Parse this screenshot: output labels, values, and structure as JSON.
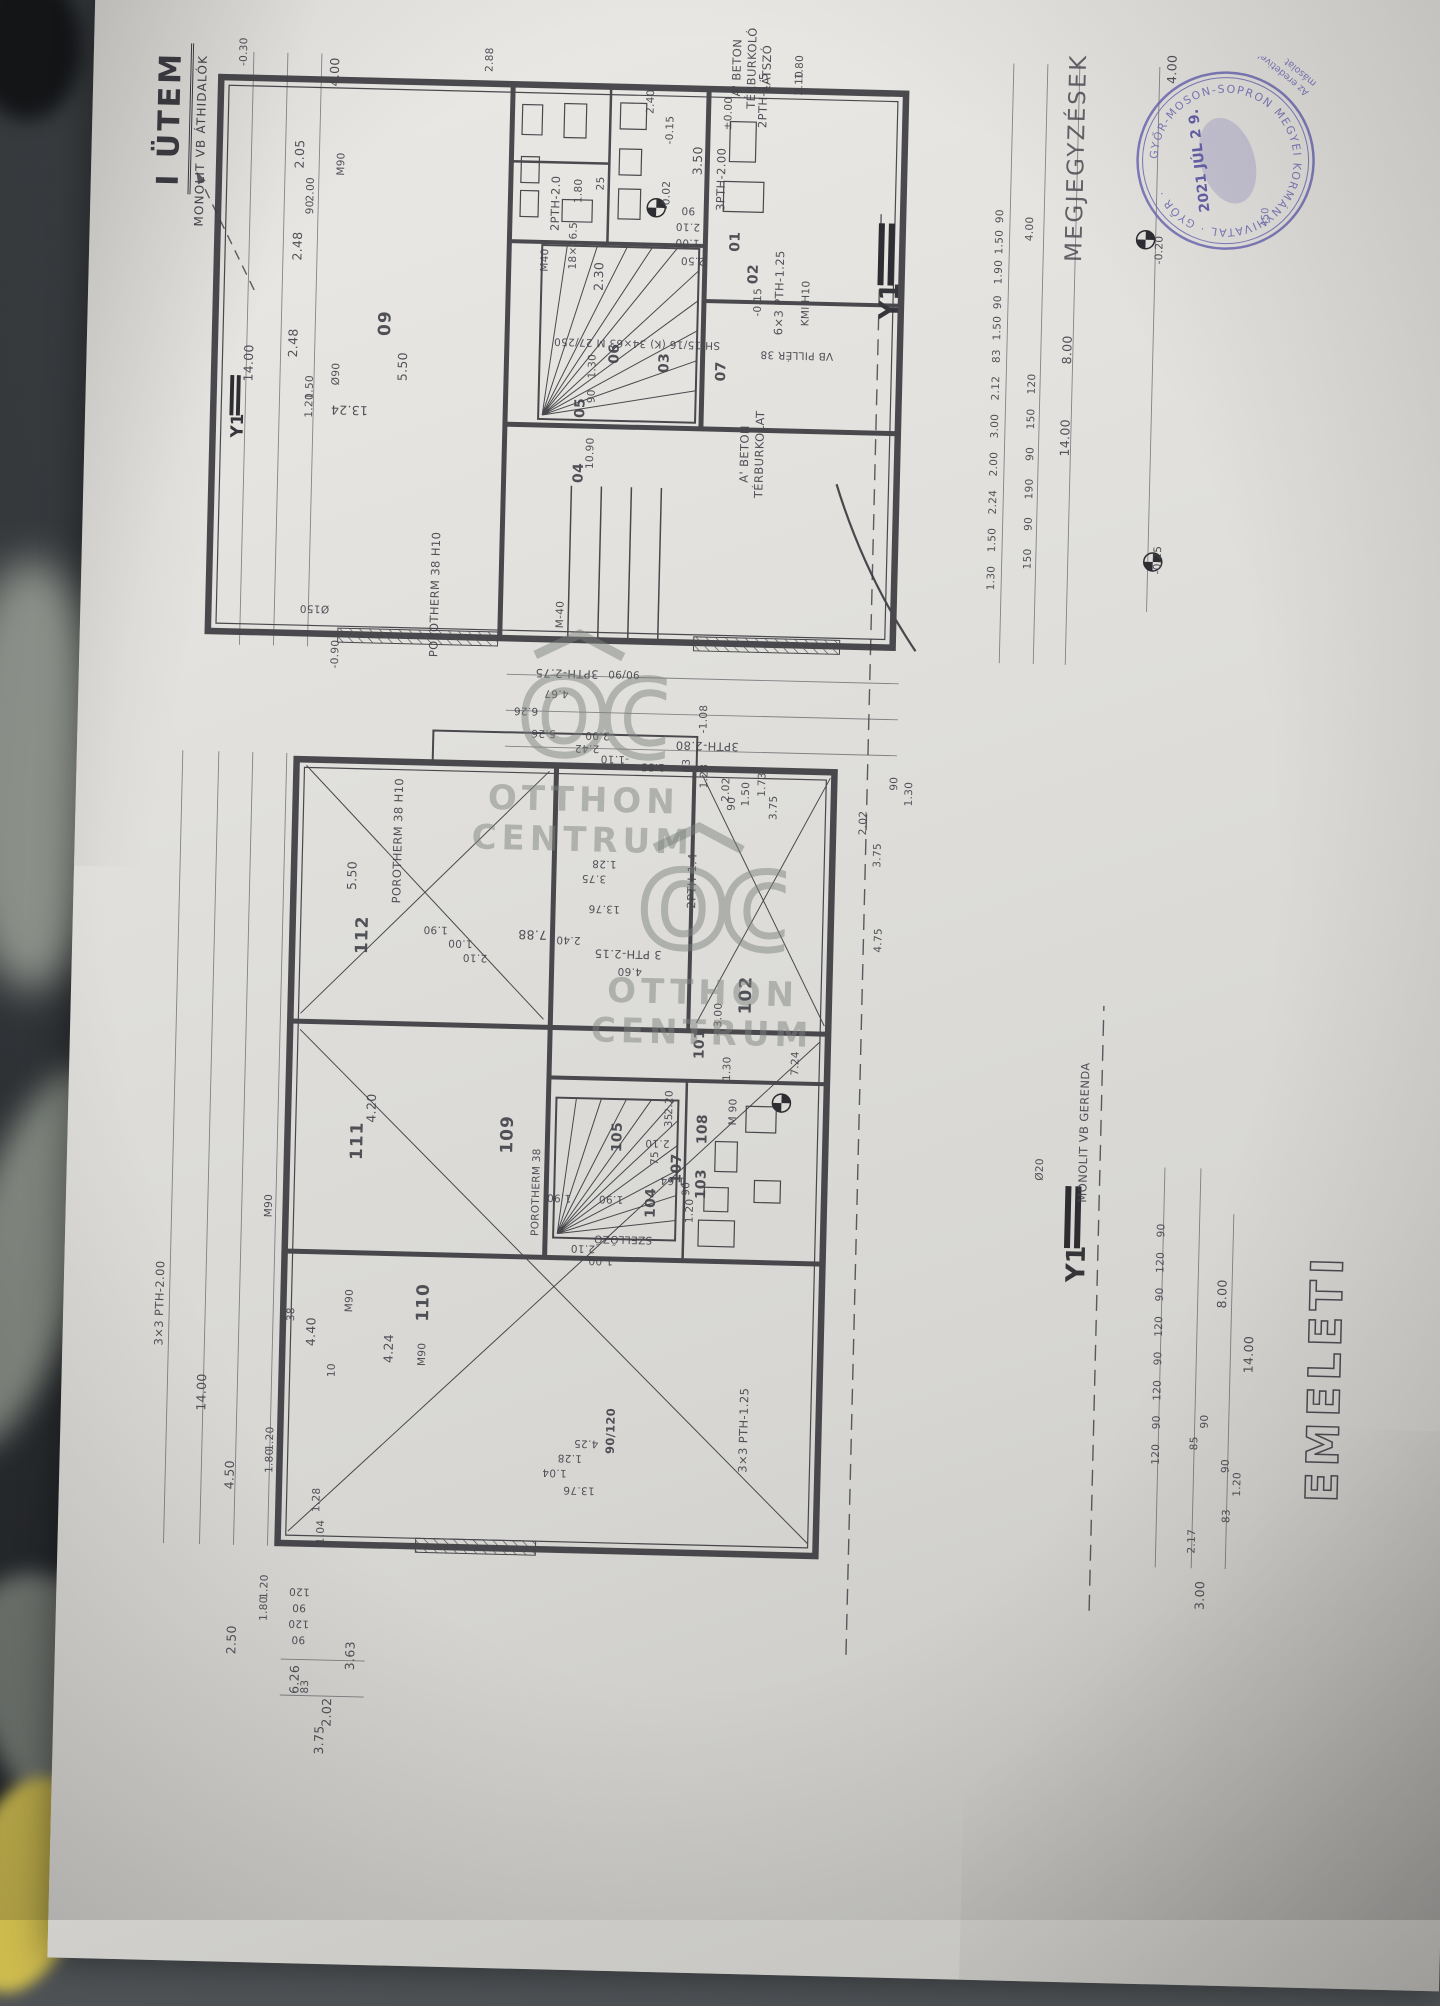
{
  "titles": {
    "phase": "I ÜTEM",
    "phase_note": "MONOLIT VB ÁTHIDALÓK",
    "sheet": "EMELETI",
    "notes_heading": "MEGJEGYZÉSEK:"
  },
  "axis": {
    "y1": "Y1"
  },
  "stamp": {
    "ring_text": "GYŐR-MOSON-SOPRON MEGYEI KORMÁNYHIVATAL · GYŐR ·",
    "date": "2021 JÚL 2 9.",
    "number": "450",
    "note_line1": "Az eredetivel megegyező",
    "note_line2": "másolat"
  },
  "watermark": {
    "logo": "OC",
    "line1": "OTTHON",
    "line2": "CENTRUM"
  },
  "labels": [
    {
      "t": "-0.30",
      "x": 1838,
      "y": 92,
      "c": "sm"
    },
    {
      "t": "4.00",
      "x": 1820,
      "y": 183
    },
    {
      "t": "2.05",
      "x": 1737,
      "y": 150
    },
    {
      "t": "2.00",
      "x": 1702,
      "y": 162,
      "c": "sm"
    },
    {
      "t": "90",
      "x": 1684,
      "y": 162,
      "c": "sm"
    },
    {
      "t": "2.48",
      "x": 1645,
      "y": 150
    },
    {
      "t": "2.48",
      "x": 1548,
      "y": 148
    },
    {
      "t": "14.00",
      "x": 1527,
      "y": 104
    },
    {
      "t": "1.50",
      "x": 1504,
      "y": 166,
      "c": "sm"
    },
    {
      "t": "1.20",
      "x": 1486,
      "y": 166,
      "c": "sm"
    },
    {
      "t": "Ø90",
      "x": 1518,
      "y": 192,
      "c": "sm"
    },
    {
      "t": "M90",
      "x": 1728,
      "y": 192,
      "c": "sm"
    },
    {
      "t": "2.88",
      "x": 1836,
      "y": 338,
      "c": "sm"
    },
    {
      "t": "09",
      "x": 1570,
      "y": 240,
      "c": "room"
    },
    {
      "t": "5.50",
      "x": 1527,
      "y": 258
    },
    {
      "t": "13.24",
      "x": 1482,
      "y": 206,
      "r": -90
    },
    {
      "t": "Ø150",
      "x": 1283,
      "y": 176,
      "r": -90,
      "c": "sm"
    },
    {
      "t": "-0.90",
      "x": 1238,
      "y": 198,
      "c": "sm"
    },
    {
      "t": "POROTHERM 38 H10",
      "x": 1300,
      "y": 296,
      "c": "note"
    },
    {
      "t": "2PTH-2.0",
      "x": 1694,
      "y": 407,
      "c": "note"
    },
    {
      "t": "1.80",
      "x": 1707,
      "y": 430,
      "c": "sm"
    },
    {
      "t": "25",
      "x": 1715,
      "y": 452,
      "c": "sm"
    },
    {
      "t": "2.30",
      "x": 1622,
      "y": 452
    },
    {
      "t": "1.30",
      "x": 1532,
      "y": 448,
      "c": "sm"
    },
    {
      "t": "90",
      "x": 1502,
      "y": 448,
      "c": "sm"
    },
    {
      "t": "10.90",
      "x": 1445,
      "y": 448,
      "c": "sm"
    },
    {
      "t": "SH 15/16 (K) 34×63 M 27/250",
      "x": 1556,
      "y": 492,
      "r": -90,
      "c": "sm"
    },
    {
      "t": "18×16.5",
      "x": 1652,
      "y": 426,
      "c": "sm"
    },
    {
      "t": "M40",
      "x": 1637,
      "y": 398,
      "c": "sm"
    },
    {
      "t": "05",
      "x": 1490,
      "y": 437,
      "c": "room-sm"
    },
    {
      "t": "04",
      "x": 1425,
      "y": 437,
      "c": "room-sm"
    },
    {
      "t": "06",
      "x": 1545,
      "y": 470,
      "c": "room-sm"
    },
    {
      "t": "07",
      "x": 1530,
      "y": 577,
      "c": "room-sm"
    },
    {
      "t": "03",
      "x": 1537,
      "y": 520,
      "c": "room-sm"
    },
    {
      "t": "1.00",
      "x": 1658,
      "y": 540,
      "r": -90,
      "c": "sm"
    },
    {
      "t": "2.10",
      "x": 1674,
      "y": 540,
      "r": -90,
      "c": "sm"
    },
    {
      "t": "90",
      "x": 1690,
      "y": 540,
      "r": -90,
      "c": "sm"
    },
    {
      "t": "2.50",
      "x": 1640,
      "y": 546,
      "r": -90,
      "c": "sm"
    },
    {
      "t": "01",
      "x": 1660,
      "y": 588,
      "c": "room-sm"
    },
    {
      "t": "3PTH-2.00",
      "x": 1722,
      "y": 572,
      "c": "note"
    },
    {
      "t": "3.50",
      "x": 1740,
      "y": 548
    },
    {
      "t": "±0.00",
      "x": 1788,
      "y": 578,
      "c": "sm"
    },
    {
      "t": "2PTH-1.5",
      "x": 1802,
      "y": 612,
      "c": "note"
    },
    {
      "t": "2.10",
      "x": 1820,
      "y": 648,
      "c": "sm"
    },
    {
      "t": "1.80",
      "x": 1836,
      "y": 648,
      "c": "sm"
    },
    {
      "t": "02",
      "x": 1628,
      "y": 607,
      "c": "room-sm"
    },
    {
      "t": "6×3 PTH-1.25",
      "x": 1610,
      "y": 633,
      "c": "note"
    },
    {
      "t": "KMI H10",
      "x": 1600,
      "y": 660,
      "c": "sm"
    },
    {
      "t": "VB PILLÉR 38",
      "x": 1548,
      "y": 652,
      "r": -90,
      "c": "sm"
    },
    {
      "t": "A' BETON",
      "x": 1834,
      "y": 585,
      "c": "note"
    },
    {
      "t": "TÉRBURKOLÓ",
      "x": 1834,
      "y": 600,
      "c": "note"
    },
    {
      "t": "LÁTSZÓ",
      "x": 1834,
      "y": 615,
      "c": "note"
    },
    {
      "t": "A' BETON",
      "x": 1448,
      "y": 602,
      "c": "note"
    },
    {
      "t": "TÉRBURKOLAT",
      "x": 1448,
      "y": 617,
      "c": "note"
    },
    {
      "t": "-0.15",
      "x": 1770,
      "y": 520,
      "c": "sm"
    },
    {
      "t": "-0.02",
      "x": 1705,
      "y": 518,
      "c": "sm"
    },
    {
      "t": "2.40",
      "x": 1798,
      "y": 500,
      "c": "sm"
    },
    {
      "t": "-0.15",
      "x": 1600,
      "y": 612,
      "c": "sm"
    },
    {
      "t": "6.26",
      "x": 1186,
      "y": 390,
      "r": -90,
      "c": "sm"
    },
    {
      "t": "4.67",
      "x": 1204,
      "y": 420,
      "r": -90,
      "c": "sm"
    },
    {
      "t": "5.26",
      "x": 1164,
      "y": 408,
      "r": -90,
      "c": "sm"
    },
    {
      "t": "3PTH-2.75",
      "x": 1224,
      "y": 430,
      "r": -90,
      "c": "note"
    },
    {
      "t": "3PTH-2.80",
      "x": 1155,
      "y": 572,
      "r": -90,
      "c": "note"
    },
    {
      "t": "M-40",
      "x": 1283,
      "y": 422,
      "c": "sm"
    },
    {
      "t": "2.42",
      "x": 1150,
      "y": 452,
      "r": -90,
      "c": "sm"
    },
    {
      "t": "2.00",
      "x": 1163,
      "y": 462,
      "r": -90,
      "c": "sm"
    },
    {
      "t": "-1.10",
      "x": 1140,
      "y": 480,
      "r": -90,
      "c": "sm"
    },
    {
      "t": "1.55",
      "x": 1133,
      "y": 518,
      "r": -90,
      "c": "sm"
    },
    {
      "t": "-1.08",
      "x": 1182,
      "y": 568,
      "c": "sm"
    },
    {
      "t": "90/90",
      "x": 1225,
      "y": 487,
      "r": -90,
      "c": "sm"
    },
    {
      "t": "1.50",
      "x": 1108,
      "y": 612,
      "c": "sm"
    },
    {
      "t": "90",
      "x": 1098,
      "y": 598,
      "c": "sm"
    },
    {
      "t": "1.73",
      "x": 1118,
      "y": 628,
      "c": "sm"
    },
    {
      "t": "2.02",
      "x": 1112,
      "y": 592,
      "c": "sm"
    },
    {
      "t": "1.28",
      "x": 1125,
      "y": 570,
      "c": "sm"
    },
    {
      "t": "83",
      "x": 1135,
      "y": 552,
      "c": "sm"
    },
    {
      "t": "3.75",
      "x": 1095,
      "y": 640,
      "c": "sm"
    },
    {
      "t": "2.02",
      "x": 1082,
      "y": 730,
      "c": "sm"
    },
    {
      "t": "3.75",
      "x": 1050,
      "y": 745,
      "c": "sm"
    },
    {
      "t": "90",
      "x": 1122,
      "y": 760,
      "c": "sm"
    },
    {
      "t": "1.30",
      "x": 1112,
      "y": 775,
      "c": "sm"
    },
    {
      "t": "4.75",
      "x": 965,
      "y": 748,
      "c": "sm"
    },
    {
      "t": "112",
      "x": 958,
      "y": 232,
      "c": "room"
    },
    {
      "t": "111",
      "x": 752,
      "y": 232,
      "c": "room"
    },
    {
      "t": "110",
      "x": 592,
      "y": 302,
      "c": "room"
    },
    {
      "t": "109",
      "x": 762,
      "y": 382,
      "c": "room"
    },
    {
      "t": "101",
      "x": 857,
      "y": 572,
      "c": "room-sm"
    },
    {
      "t": "+3.00",
      "x": 882,
      "y": 590,
      "c": "sm"
    },
    {
      "t": "102",
      "x": 907,
      "y": 617,
      "c": "room"
    },
    {
      "t": "7.24",
      "x": 840,
      "y": 668,
      "c": "sm"
    },
    {
      "t": "103",
      "x": 717,
      "y": 577,
      "c": "room-sm"
    },
    {
      "t": "104",
      "x": 697,
      "y": 527,
      "c": "room-sm"
    },
    {
      "t": "105",
      "x": 762,
      "y": 492,
      "c": "room-sm"
    },
    {
      "t": "107",
      "x": 732,
      "y": 552,
      "c": "room-sm"
    },
    {
      "t": "108",
      "x": 772,
      "y": 577,
      "c": "room-sm"
    },
    {
      "t": "4.20",
      "x": 785,
      "y": 245
    },
    {
      "t": "4.40",
      "x": 560,
      "y": 190
    },
    {
      "t": "38",
      "x": 577,
      "y": 170,
      "c": "sm"
    },
    {
      "t": "4.24",
      "x": 545,
      "y": 268
    },
    {
      "t": "M90",
      "x": 592,
      "y": 228,
      "c": "sm"
    },
    {
      "t": "M90",
      "x": 540,
      "y": 302,
      "c": "sm"
    },
    {
      "t": "M90",
      "x": 685,
      "y": 145,
      "c": "sm"
    },
    {
      "t": "10",
      "x": 522,
      "y": 212,
      "c": "sm"
    },
    {
      "t": "5.50",
      "x": 1017,
      "y": 220
    },
    {
      "t": "1.90",
      "x": 965,
      "y": 305,
      "r": -90,
      "c": "sm"
    },
    {
      "t": "1.00",
      "x": 952,
      "y": 330,
      "r": -90,
      "c": "sm"
    },
    {
      "t": "2.10",
      "x": 938,
      "y": 345,
      "r": -90,
      "c": "sm"
    },
    {
      "t": "POROTHERM 38 H10",
      "x": 1053,
      "y": 265,
      "c": "note"
    },
    {
      "t": "3 PTH-2.15",
      "x": 945,
      "y": 498,
      "r": -90,
      "c": "note"
    },
    {
      "t": "2.40",
      "x": 958,
      "y": 438,
      "r": -90,
      "c": "sm"
    },
    {
      "t": "4.60",
      "x": 928,
      "y": 500,
      "r": -90,
      "c": "sm"
    },
    {
      "t": "1.90",
      "x": 700,
      "y": 435,
      "r": -90,
      "c": "sm"
    },
    {
      "t": "1.90",
      "x": 700,
      "y": 487,
      "r": -90,
      "c": "sm"
    },
    {
      "t": "2.10",
      "x": 650,
      "y": 460,
      "r": -90,
      "c": "sm"
    },
    {
      "t": "1.00",
      "x": 638,
      "y": 478,
      "r": -90,
      "c": "sm"
    },
    {
      "t": "2.20",
      "x": 798,
      "y": 543,
      "c": "sm"
    },
    {
      "t": "35",
      "x": 780,
      "y": 543,
      "c": "sm"
    },
    {
      "t": "M 90",
      "x": 790,
      "y": 607,
      "c": "sm"
    },
    {
      "t": "1.30",
      "x": 833,
      "y": 600,
      "c": "sm"
    },
    {
      "t": "75",
      "x": 742,
      "y": 530,
      "c": "sm"
    },
    {
      "t": "2.10",
      "x": 757,
      "y": 532,
      "r": -90,
      "c": "sm"
    },
    {
      "t": "1.64",
      "x": 720,
      "y": 548,
      "r": -90,
      "c": "sm"
    },
    {
      "t": "90",
      "x": 712,
      "y": 562,
      "c": "sm"
    },
    {
      "t": "1.20",
      "x": 690,
      "y": 566,
      "c": "sm"
    },
    {
      "t": "SZELLŐZŐ",
      "x": 660,
      "y": 500,
      "r": -90,
      "c": "sm"
    },
    {
      "t": "POROTHERM 38",
      "x": 705,
      "y": 412,
      "c": "sm"
    },
    {
      "t": "90/120",
      "x": 468,
      "y": 492,
      "c": "smb"
    },
    {
      "t": "2PTH-1.4",
      "x": 1020,
      "y": 560,
      "c": "note"
    },
    {
      "t": "3×3 PTH-1.25",
      "x": 472,
      "y": 625,
      "c": "note"
    },
    {
      "t": "1.04",
      "x": 425,
      "y": 437,
      "r": -90,
      "c": "sm"
    },
    {
      "t": "1.28",
      "x": 440,
      "y": 452,
      "r": -90,
      "c": "sm"
    },
    {
      "t": "4.25",
      "x": 455,
      "y": 468,
      "r": -90,
      "c": "sm"
    },
    {
      "t": "13.76",
      "x": 408,
      "y": 462,
      "r": -90,
      "c": "sm"
    },
    {
      "t": "13.76",
      "x": 990,
      "y": 473,
      "r": -90,
      "c": "sm"
    },
    {
      "t": "3.75",
      "x": 1020,
      "y": 462,
      "r": -90,
      "c": "sm"
    },
    {
      "t": "1.28",
      "x": 1035,
      "y": 472,
      "r": -90,
      "c": "sm"
    },
    {
      "t": "7.88",
      "x": 962,
      "y": 402,
      "r": -90
    },
    {
      "t": "3×3 PTH-2.00",
      "x": 585,
      "y": 38,
      "c": "note"
    },
    {
      "t": "14.00",
      "x": 497,
      "y": 82
    },
    {
      "t": "4.50",
      "x": 415,
      "y": 112
    },
    {
      "t": "2.50",
      "x": 250,
      "y": 118
    },
    {
      "t": "1.80",
      "x": 430,
      "y": 152,
      "c": "sm"
    },
    {
      "t": "1.20",
      "x": 452,
      "y": 152,
      "c": "sm"
    },
    {
      "t": "1.80",
      "x": 282,
      "y": 150,
      "c": "sm"
    },
    {
      "t": "1.20",
      "x": 304,
      "y": 150,
      "c": "sm"
    },
    {
      "t": "120",
      "x": 458,
      "y": 1038,
      "c": "sm"
    },
    {
      "t": "90",
      "x": 490,
      "y": 1038,
      "c": "sm"
    },
    {
      "t": "120",
      "x": 522,
      "y": 1038,
      "c": "sm"
    },
    {
      "t": "90",
      "x": 554,
      "y": 1038,
      "c": "sm"
    },
    {
      "t": "120",
      "x": 586,
      "y": 1038,
      "c": "sm"
    },
    {
      "t": "90",
      "x": 618,
      "y": 1038,
      "c": "sm"
    },
    {
      "t": "120",
      "x": 650,
      "y": 1038,
      "c": "sm"
    },
    {
      "t": "90",
      "x": 682,
      "y": 1038,
      "c": "sm"
    },
    {
      "t": "85",
      "x": 470,
      "y": 1076,
      "c": "sm"
    },
    {
      "t": "90",
      "x": 492,
      "y": 1086,
      "c": "sm"
    },
    {
      "t": "8.00",
      "x": 620,
      "y": 1100
    },
    {
      "t": "14.00",
      "x": 560,
      "y": 1128
    },
    {
      "t": "2.17",
      "x": 372,
      "y": 1076,
      "c": "sm"
    },
    {
      "t": "3.00",
      "x": 318,
      "y": 1085
    },
    {
      "t": "1.20",
      "x": 430,
      "y": 1120,
      "c": "sm"
    },
    {
      "t": "83",
      "x": 398,
      "y": 1110,
      "c": "sm"
    },
    {
      "t": "90",
      "x": 448,
      "y": 1108,
      "c": "sm"
    },
    {
      "t": "3.63",
      "x": 237,
      "y": 237
    },
    {
      "t": "6.26",
      "x": 212,
      "y": 182
    },
    {
      "t": "2.02",
      "x": 180,
      "y": 215
    },
    {
      "t": "3.75",
      "x": 152,
      "y": 208
    },
    {
      "t": "83",
      "x": 205,
      "y": 193,
      "c": "sm"
    },
    {
      "t": "1.28",
      "x": 392,
      "y": 200,
      "c": "sm"
    },
    {
      "t": "1.04",
      "x": 360,
      "y": 205,
      "c": "sm"
    },
    {
      "t": "90",
      "x": 252,
      "y": 185,
      "r": -90,
      "c": "sm"
    },
    {
      "t": "120",
      "x": 268,
      "y": 185,
      "r": -90,
      "c": "sm"
    },
    {
      "t": "90",
      "x": 284,
      "y": 185,
      "r": -90,
      "c": "sm"
    },
    {
      "t": "120",
      "x": 300,
      "y": 185,
      "r": -90,
      "c": "sm"
    },
    {
      "t": "1.30",
      "x": 1330,
      "y": 852,
      "c": "sm"
    },
    {
      "t": "1.50",
      "x": 1368,
      "y": 852,
      "c": "sm"
    },
    {
      "t": "2.24",
      "x": 1406,
      "y": 852,
      "c": "sm"
    },
    {
      "t": "2.00",
      "x": 1444,
      "y": 852,
      "c": "sm"
    },
    {
      "t": "3.00",
      "x": 1482,
      "y": 852,
      "c": "sm"
    },
    {
      "t": "2.12",
      "x": 1520,
      "y": 852,
      "c": "sm"
    },
    {
      "t": "83",
      "x": 1552,
      "y": 852,
      "c": "sm"
    },
    {
      "t": "1.50",
      "x": 1580,
      "y": 852,
      "c": "sm"
    },
    {
      "t": "90",
      "x": 1606,
      "y": 852,
      "c": "sm"
    },
    {
      "t": "1.90",
      "x": 1636,
      "y": 852,
      "c": "sm"
    },
    {
      "t": "1.50",
      "x": 1666,
      "y": 852,
      "c": "sm"
    },
    {
      "t": "90",
      "x": 1692,
      "y": 852,
      "c": "sm"
    },
    {
      "t": "150",
      "x": 1350,
      "y": 888,
      "c": "sm"
    },
    {
      "t": "90",
      "x": 1385,
      "y": 888,
      "c": "sm"
    },
    {
      "t": "190",
      "x": 1420,
      "y": 888,
      "c": "sm"
    },
    {
      "t": "90",
      "x": 1455,
      "y": 888,
      "c": "sm"
    },
    {
      "t": "150",
      "x": 1490,
      "y": 888,
      "c": "sm"
    },
    {
      "t": "120",
      "x": 1525,
      "y": 888,
      "c": "sm"
    },
    {
      "t": "14.00",
      "x": 1472,
      "y": 922
    },
    {
      "t": "8.00",
      "x": 1560,
      "y": 922
    },
    {
      "t": "4.00",
      "x": 1843,
      "y": 1020
    },
    {
      "t": "-0.20",
      "x": 1662,
      "y": 1012,
      "c": "sm"
    },
    {
      "t": "-0.25",
      "x": 1352,
      "y": 1018,
      "c": "sm"
    },
    {
      "t": "4.00",
      "x": 1680,
      "y": 882,
      "c": "sm"
    },
    {
      "t": "Ø20",
      "x": 740,
      "y": 915,
      "c": "sm"
    },
    {
      "t": "MONOLIT VB GERENDA",
      "x": 778,
      "y": 958,
      "c": "note"
    }
  ]
}
